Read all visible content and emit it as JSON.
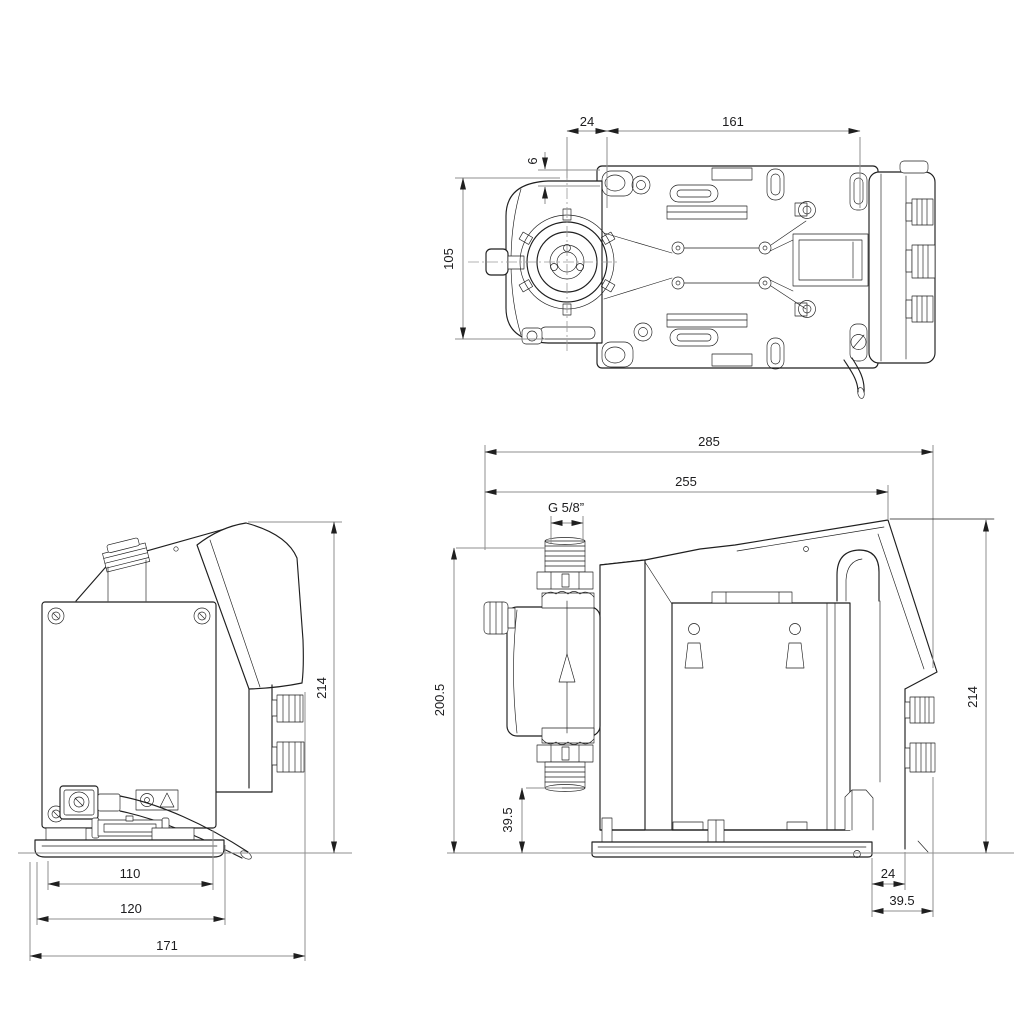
{
  "drawing": {
    "type": "technical-dimension-drawing",
    "subject": "dosing pump dimensional drawing, three orthographic views",
    "colors": {
      "background": "#ffffff",
      "outline": "#1f1f1f",
      "dimension_lines": "#8f8f8f",
      "dimension_text": "#1c1c1e"
    },
    "views": {
      "top": {
        "dims": {
          "d24": "24",
          "d161": "161",
          "d6": "6",
          "d105": "105"
        }
      },
      "back": {
        "dims": {
          "d214": "214",
          "d110": "110",
          "d120": "120",
          "d171": "171"
        }
      },
      "side": {
        "dims": {
          "d285": "285",
          "d255": "255",
          "thread": "G 5/8”",
          "d200_5": "200.5",
          "d39_5_left": "39.5",
          "d214": "214",
          "d24": "24",
          "d39_5_bottom": "39.5"
        }
      }
    }
  }
}
